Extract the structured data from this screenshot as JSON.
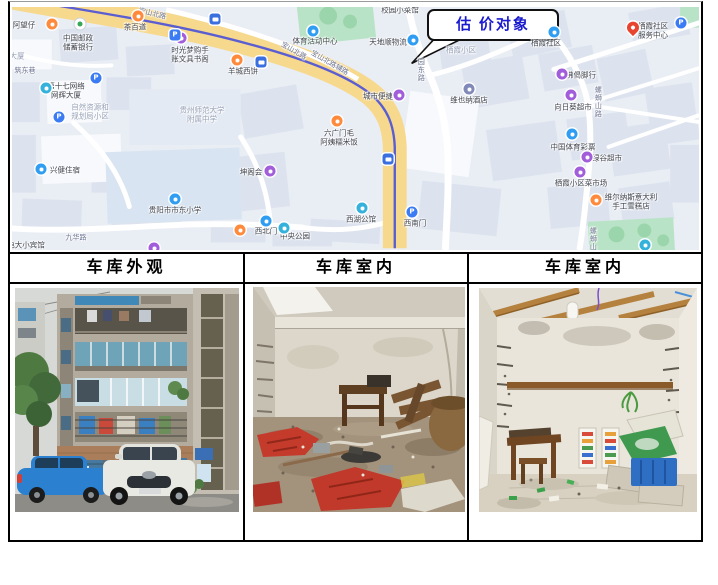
{
  "document": {
    "callout": {
      "label": "估 价对象",
      "color": "#1b1bd0"
    },
    "table": {
      "headers": [
        {
          "label": "车库外观"
        },
        {
          "label": "车库室内"
        },
        {
          "label": "车库室内"
        }
      ]
    },
    "photos": [
      {
        "description": "车库外观：多层旧住宅楼，底层为蓝色卷帘门车库，门前停有蓝色轿车和白色轿车"
      },
      {
        "description": "车库室内：墙面斑驳，地面堆放红色布料、木桌椅、木料及杂物"
      },
      {
        "description": "车库室内：空置房间，白墙木梁吊灯，墙面挂横木，左侧木桌凳，右侧蓝色塑料箱"
      }
    ]
  },
  "map": {
    "colors": {
      "background": "#e9edf4",
      "building": "#dde3ee",
      "building_light": "#f7f9fc",
      "park": "#b9e3c6",
      "main_road": "#f7d98e",
      "rail_line": "#5b5ed0",
      "street": "#ffffff"
    },
    "icon_colors": {
      "orange": "#ff8a3c",
      "purple": "#a25ddb",
      "blue": "#2f9df2",
      "teal": "#35b2dc",
      "p": "#3b7cf5",
      "psq": "#3b7cf5",
      "bus": "#3a6fe0",
      "red": "#e8432e",
      "leaf": "#ffffff",
      "hotel": "#8089b8"
    },
    "labels": [
      {
        "text": "阿望仔",
        "x": 12,
        "y": 18
      },
      {
        "lines": [
          "中国邮政",
          "储蓄银行"
        ],
        "x": 66,
        "y": 36
      },
      {
        "text": "茶百道",
        "x": 123,
        "y": 20
      },
      {
        "lines": [
          "时光梦购手",
          "账文具书阁"
        ],
        "x": 178,
        "y": 48
      },
      {
        "text": "羊城西饼",
        "x": 231,
        "y": 64
      },
      {
        "text": "体育活动中心",
        "x": 303,
        "y": 34
      },
      {
        "text": "大厦",
        "x": 5,
        "y": 49,
        "kind": "area"
      },
      {
        "text": "筑东巷",
        "x": 13,
        "y": 65,
        "kind": "road"
      },
      {
        "lines": [
          "第十七网络",
          "网辉大厦"
        ],
        "x": 54,
        "y": 84
      },
      {
        "lines": [
          "自然资源和",
          "规划局小区"
        ],
        "x": 78,
        "y": 105,
        "kind": "area"
      },
      {
        "lines": [
          "贵州师范大学",
          "附属中学"
        ],
        "x": 190,
        "y": 108,
        "kind": "area"
      },
      {
        "text": "兴健住宿",
        "x": 53,
        "y": 163
      },
      {
        "text": "坤阁会",
        "x": 239,
        "y": 165
      },
      {
        "lines": [
          "六广门毛",
          "阿姨糯米饭"
        ],
        "x": 327,
        "y": 131
      },
      {
        "text": "贵阳市市东小学",
        "x": 163,
        "y": 203
      },
      {
        "text": "九华路",
        "x": 64,
        "y": 232,
        "kind": "road"
      },
      {
        "text": "电大小宾馆",
        "x": 14,
        "y": 238
      },
      {
        "text": "西湖公馆",
        "x": 349,
        "y": 212
      },
      {
        "text": "西南门",
        "x": 403,
        "y": 216
      },
      {
        "text": "西北门",
        "x": 254,
        "y": 224
      },
      {
        "text": "中央公园",
        "x": 283,
        "y": 229
      },
      {
        "text": "城市便捷",
        "x": 366,
        "y": 89
      },
      {
        "text": "天地顺物流",
        "x": 376,
        "y": 35
      },
      {
        "text": "校园小菜馆",
        "x": 388,
        "y": 3
      },
      {
        "text": "栖霞小区",
        "x": 449,
        "y": 43,
        "kind": "area"
      },
      {
        "text": "栖霞社区",
        "x": 534,
        "y": 36
      },
      {
        "lines": [
          "栖霞社区",
          "服务中心"
        ],
        "x": 641,
        "y": 24
      },
      {
        "text": "佛偈脚行",
        "x": 569,
        "y": 68
      },
      {
        "text": "向日葵超市",
        "x": 561,
        "y": 100
      },
      {
        "text": "中国体育彩票",
        "x": 561,
        "y": 140
      },
      {
        "text": "绿谷超市",
        "x": 595,
        "y": 151
      },
      {
        "text": "栖霞小区菜市场",
        "x": 569,
        "y": 176
      },
      {
        "lines": [
          "维尔纳斯意大利",
          "手工雪糕店"
        ],
        "x": 619,
        "y": 195
      },
      {
        "text": "维也纳酒店",
        "x": 457,
        "y": 93
      },
      {
        "text": "宝山北路",
        "x": 140,
        "y": 8,
        "kind": "road",
        "rot": 14
      },
      {
        "text": "宝山北路",
        "x": 281,
        "y": 45,
        "kind": "road",
        "rot": 30
      },
      {
        "text": "宝山北路辅路",
        "x": 317,
        "y": 57,
        "kind": "road",
        "rot": 30
      },
      {
        "text": "园东路",
        "x": 408,
        "y": 63,
        "kind": "road",
        "vertical": true
      },
      {
        "text": "螺蛳山路",
        "x": 585,
        "y": 95,
        "kind": "road",
        "vertical": true
      },
      {
        "text": "螺蛳山",
        "x": 580,
        "y": 232,
        "kind": "road",
        "vertical": true
      }
    ],
    "icons": [
      {
        "icon": "orange",
        "x": 40,
        "y": 17
      },
      {
        "icon": "leaf",
        "x": 68,
        "y": 17
      },
      {
        "icon": "orange",
        "x": 126,
        "y": 9
      },
      {
        "icon": "purple",
        "x": 169,
        "y": 31
      },
      {
        "icon": "orange",
        "x": 225,
        "y": 53
      },
      {
        "icon": "blue",
        "x": 301,
        "y": 24
      },
      {
        "icon": "teal",
        "x": 34,
        "y": 81
      },
      {
        "icon": "p",
        "x": 84,
        "y": 71
      },
      {
        "icon": "p",
        "x": 47,
        "y": 110
      },
      {
        "icon": "psq",
        "x": 163,
        "y": 28
      },
      {
        "icon": "bus",
        "x": 203,
        "y": 12
      },
      {
        "icon": "bus",
        "x": 249,
        "y": 55
      },
      {
        "icon": "blue",
        "x": 29,
        "y": 162
      },
      {
        "icon": "purple",
        "x": 258,
        "y": 164
      },
      {
        "icon": "orange",
        "x": 325,
        "y": 114
      },
      {
        "icon": "blue",
        "x": 163,
        "y": 192
      },
      {
        "icon": "orange",
        "x": 228,
        "y": 223
      },
      {
        "icon": "teal",
        "x": 272,
        "y": 221
      },
      {
        "icon": "blue",
        "x": 254,
        "y": 214
      },
      {
        "icon": "p",
        "x": 400,
        "y": 205
      },
      {
        "icon": "teal",
        "x": 350,
        "y": 201
      },
      {
        "icon": "purple",
        "x": 142,
        "y": 241
      },
      {
        "icon": "purple",
        "x": 387,
        "y": 88
      },
      {
        "icon": "blue",
        "x": 401,
        "y": 33
      },
      {
        "icon": "bus",
        "x": 376,
        "y": 152
      },
      {
        "icon": "blue",
        "x": 542,
        "y": 25
      },
      {
        "icon": "red",
        "x": 621,
        "y": 23
      },
      {
        "icon": "p",
        "x": 669,
        "y": 16
      },
      {
        "icon": "purple",
        "x": 550,
        "y": 67
      },
      {
        "icon": "purple",
        "x": 559,
        "y": 88
      },
      {
        "icon": "blue",
        "x": 560,
        "y": 127
      },
      {
        "icon": "purple",
        "x": 575,
        "y": 150
      },
      {
        "icon": "purple",
        "x": 568,
        "y": 165
      },
      {
        "icon": "orange",
        "x": 584,
        "y": 193
      },
      {
        "icon": "hotel",
        "x": 457,
        "y": 82
      },
      {
        "icon": "teal",
        "x": 633,
        "y": 238
      }
    ]
  }
}
